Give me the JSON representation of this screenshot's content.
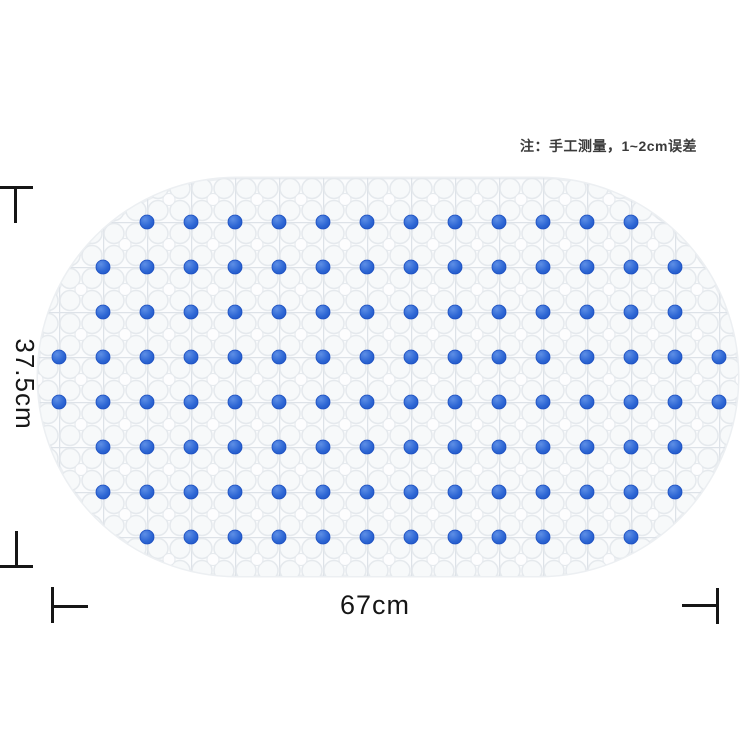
{
  "note": {
    "text": "注：手工测量，1~2cm误差",
    "color": "#3a3a3a"
  },
  "dimensions": {
    "height_label": "37.5cm",
    "width_label": "67cm",
    "line_color": "#161616"
  },
  "mat": {
    "description": "oval transparent PVC anti-slip bath mat with grid of blue suction dots",
    "body_color": "#fbfcfd",
    "edge_color": "#eceff2",
    "texture_color": "#e5e9ed",
    "grid_line_color": "#dde2e8",
    "bubble_fill": "#f7f9fa",
    "dot_color": "#2d66d4",
    "dot_highlight": "#5e8fe6",
    "dot_shadow": "#1c4fc0",
    "shape": {
      "x": 38,
      "y": 178,
      "width": 700,
      "height": 398,
      "corner_radius": 199
    },
    "dot_grid": {
      "dot_radius": 7,
      "col_x": [
        59,
        103,
        147,
        191,
        235,
        279,
        323,
        367,
        411,
        455,
        499,
        543,
        587,
        631,
        675,
        719
      ],
      "rows": [
        {
          "y": 222,
          "from": 2,
          "to": 13
        },
        {
          "y": 267,
          "from": 1,
          "to": 14
        },
        {
          "y": 312,
          "from": 1,
          "to": 14
        },
        {
          "y": 357,
          "from": 0,
          "to": 15
        },
        {
          "y": 402,
          "from": 0,
          "to": 15
        },
        {
          "y": 447,
          "from": 1,
          "to": 14
        },
        {
          "y": 492,
          "from": 1,
          "to": 14
        },
        {
          "y": 537,
          "from": 2,
          "to": 13
        }
      ]
    }
  }
}
